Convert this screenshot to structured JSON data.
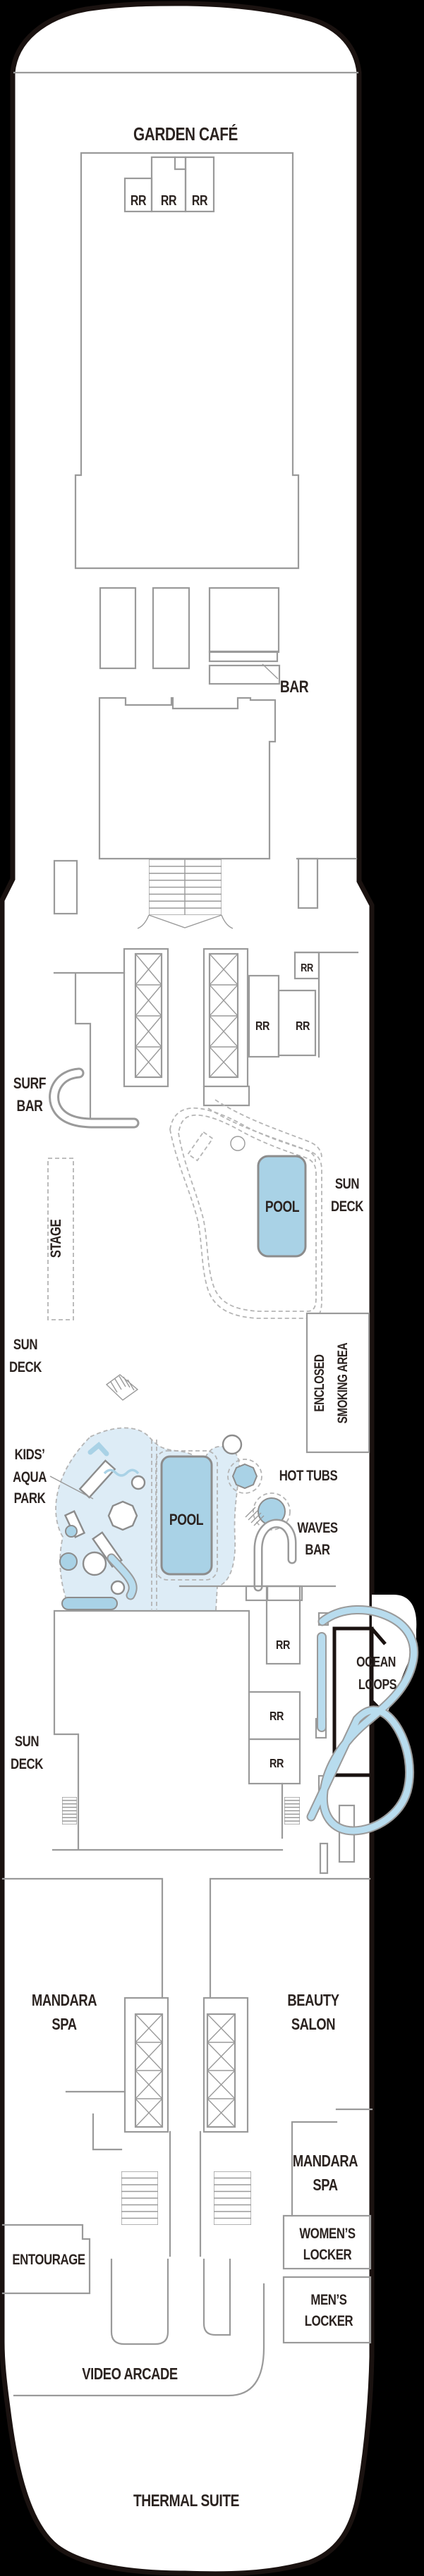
{
  "colors": {
    "background": "#000000",
    "hull_fill": "#ffffff",
    "hull_stroke": "#1a1210",
    "wall": "#9a9a9a",
    "pool_fill": "#a9d2e6",
    "splash_fill": "#ddecf6",
    "slide_tube": "#b8dcee",
    "label_text": "#2b2320"
  },
  "deck_plan": {
    "venues": {
      "garden_cafe": "GARDEN CAFÉ",
      "rr": "RR",
      "bar": "BAR",
      "surf_1": "SURF",
      "surf_2": "BAR",
      "stage": "STAGE",
      "pool": "POOL",
      "sun_1": "SUN",
      "sun_2": "DECK",
      "smoking_1": "ENCLOSED",
      "smoking_2": "SMOKING AREA",
      "kids_1": "KIDS’",
      "kids_2": "AQUA",
      "kids_3": "PARK",
      "hot_tubs": "HOT TUBS",
      "waves_1": "WAVES",
      "waves_2": "BAR",
      "ocean_1": "OCEAN",
      "ocean_2": "LOOPS",
      "mandara_1": "MANDARA",
      "mandara_2": "SPA",
      "beauty_1": "BEAUTY",
      "beauty_2": "SALON",
      "entourage": "ENTOURAGE",
      "womens_1": "WOMEN’S",
      "womens_2": "LOCKER",
      "mens_1": "MEN’S",
      "mens_2": "LOCKER",
      "video_arcade": "VIDEO ARCADE",
      "thermal_suite": "THERMAL SUITE"
    }
  }
}
